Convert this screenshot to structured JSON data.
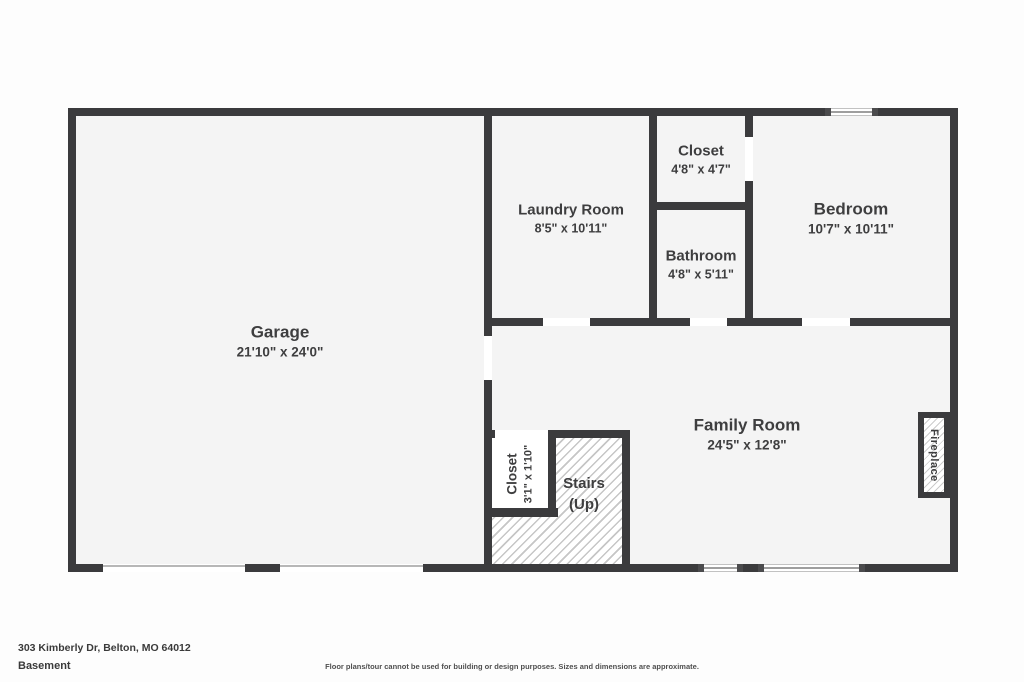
{
  "rooms": {
    "garage": {
      "name": "Garage",
      "dims": "21'10\" x 24'0\""
    },
    "laundry": {
      "name": "Laundry Room",
      "dims": "8'5\" x 10'11\""
    },
    "closet": {
      "name": "Closet",
      "dims": "4'8\" x 4'7\""
    },
    "bathroom": {
      "name": "Bathroom",
      "dims": "4'8\" x 5'11\""
    },
    "bedroom": {
      "name": "Bedroom",
      "dims": "10'7\" x 10'11\""
    },
    "family": {
      "name": "Family Room",
      "dims": "24'5\" x 12'8\""
    },
    "stair_closet": {
      "name": "Closet",
      "dims": "3'1\" x 1'10\""
    },
    "stairs": {
      "name": "Stairs",
      "sub": "(Up)"
    },
    "fireplace": {
      "name": "Fireplace"
    }
  },
  "footer": {
    "address": "303 Kimberly Dr, Belton, MO 64012",
    "level": "Basement",
    "disclaimer": "Floor plans/tour cannot be used for building or design purposes. Sizes and dimensions are approximate."
  },
  "colors": {
    "wall": "#3b3b3d",
    "room_fill": "#f4f4f4",
    "background": "#fdfdfd",
    "text": "#3e3e3f",
    "hatch_line": "#c6c6c6",
    "window_line": "#9e9e9e"
  }
}
